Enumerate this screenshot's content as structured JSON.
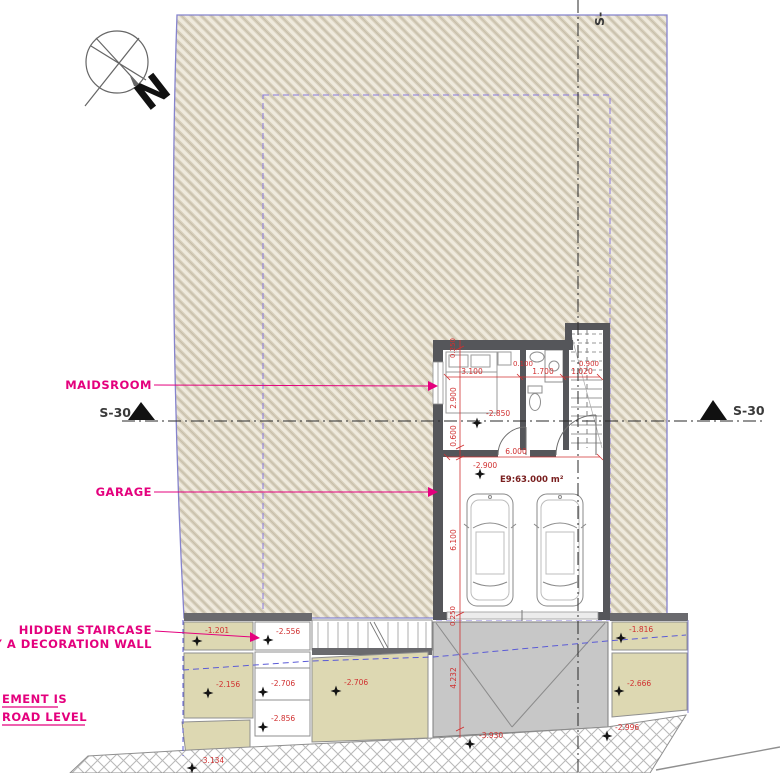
{
  "labels": {
    "north_letter": "N",
    "maidsroom": "MAIDSROOM",
    "garage": "GARAGE",
    "hidden_staircase_line1": "HIDDEN STAIRCASE",
    "hidden_staircase_line2": "BY A DECORATION WALL",
    "basement_note_line1": "EMENT IS",
    "basement_note_line2": "ROAD LEVEL",
    "section_marker_left": "S-30",
    "section_marker_right": "S-30",
    "section_marker_top": "S-"
  },
  "dims": {
    "room_width": "3.100",
    "room_depth": "2.900",
    "door_offset": "0.100",
    "bath_width": "1.700",
    "stair_width": "1.020",
    "stair_run": "0.900",
    "lower_strip": "0.600",
    "wall": "0.250",
    "garage_width": "6.000",
    "garage_depth": "6.100",
    "ramp_length": "4.232"
  },
  "elevations": {
    "maidsroom": "-2.850",
    "garage": "-2.900",
    "garage_area_label": "E9:63.000 m²",
    "plot_left_1": "-1.201",
    "plot_left_2": "-2.556",
    "plot_left_3": "-2.156",
    "plot_left_4": "-2.706",
    "plot_center": "-2.706",
    "plot_left_5": "-2.856",
    "plot_right_1": "-1.816",
    "plot_right_2": "-2.666",
    "road_right": "-2.996",
    "road_left": "-3.134",
    "ramp_bottom": "-3.930"
  },
  "colors": {
    "accent_magenta": "#e4007d",
    "dim_red": "#d03030",
    "boundary_blue": "#8583cd",
    "setback_violet": "#8a7be0",
    "wall_gray": "#55565a",
    "plot_beige": "#ddd8b2",
    "ramp_gray": "#c7c7c7"
  }
}
